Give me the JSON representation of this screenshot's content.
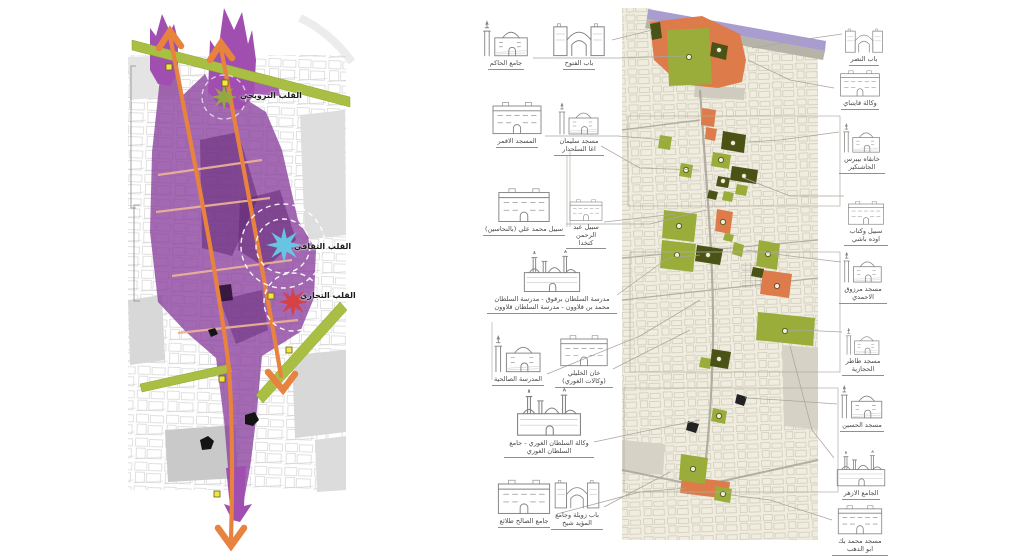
{
  "poster": {
    "left_diagram": {
      "heart_labels": [
        {
          "text": "القلب الترويحي",
          "accent_color": "#93ad3c"
        },
        {
          "text": "القلب الثقافي",
          "accent_color": "#66cbe8"
        },
        {
          "text": "القلب التجاري",
          "accent_color": "#d84040"
        }
      ],
      "icons": [
        {
          "name": "starburst-recreational-icon",
          "shape": "star8",
          "color": "#93ad3c"
        },
        {
          "name": "starburst-cultural-icon",
          "shape": "star8",
          "color": "#66cbe8"
        },
        {
          "name": "starburst-commercial-icon",
          "shape": "star8",
          "color": "#d84040"
        },
        {
          "name": "route-chevron-icon",
          "shape": "chevron",
          "color": "#e8823f"
        },
        {
          "name": "node-square-icon",
          "shape": "square",
          "color": "#f4e53a"
        }
      ],
      "colors": {
        "core_zone_purple": "#8b3f9e",
        "route_orange": "#e8823f",
        "edge_band_green": "#a9bf44",
        "desire_line_salmon": "#eab095"
      }
    },
    "monuments_map": {
      "colors": {
        "map_background": "#f0eddf",
        "monument_green": "#9aad3b",
        "monument_dark_green": "#4a5216",
        "highlight_orange": "#dd7c4a",
        "north_band_lavender": "#a99ccf"
      },
      "left_column": [
        {
          "label": "جامع الحاكم"
        },
        {
          "label": "باب الفتوح"
        },
        {
          "label": "المسجد الاقمر"
        },
        {
          "label": "مسجد سليمان اغا السلحدار"
        },
        {
          "label": "سبيل محمد علي (بالنحاسين)"
        },
        {
          "label": "سبيل عبد الرحمن كتخدا"
        },
        {
          "label": "مدرسة السلطان برقوق - مدرسة السلطان محمد بن قلاوون - مدرسة السلطان قلاوون"
        },
        {
          "label": "المدرسة الصالحية"
        },
        {
          "label": "خان الخليلي (وكالات الغوري)"
        },
        {
          "label": "وكالة السلطان الغوري - جامع السلطان الغوري"
        },
        {
          "label": "جامع الصالح طلائع"
        },
        {
          "label": "باب زويلة وجامع المؤيد شيخ"
        }
      ],
      "right_column": [
        {
          "label": "باب النصر"
        },
        {
          "label": "وكالة قايتباي"
        },
        {
          "label": "خانقاه بيبرس الجاشنكير"
        },
        {
          "label": "سبيل وكتاب اوده باشي"
        },
        {
          "label": "مسجد مرزوق الاحمدي"
        },
        {
          "label": "مسجد طاطر الحجازية"
        },
        {
          "label": "مسجد الحسين"
        },
        {
          "label": "الجامع الازهر"
        },
        {
          "label": "مسجد محمد بك ابو الدهب"
        }
      ]
    }
  }
}
